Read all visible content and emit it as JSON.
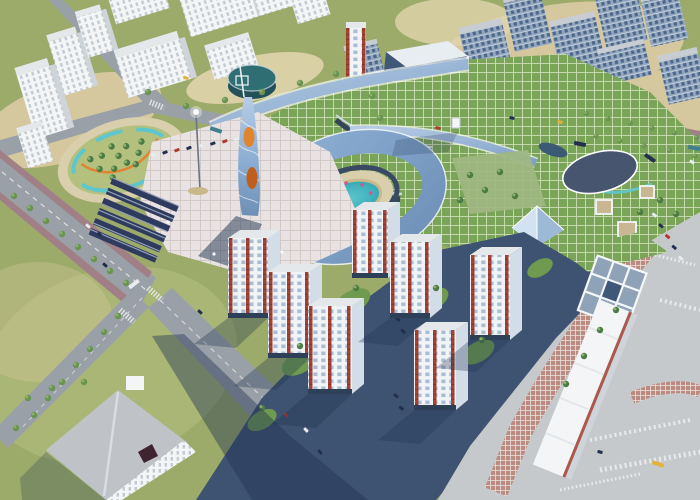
{
  "scene": {
    "type": "3d-aerial-architectural-render",
    "subject": "mixed-use development masterplan with shopping mall, ring courtyard, spiral tower, park and residential towers",
    "residential_tower_count": 9,
    "landmarks": [
      {
        "id": "spiral-tower",
        "label": "twisted glass tower with orange glowing bands"
      },
      {
        "id": "ring-building",
        "label": "C-shaped blue glass roof building around circular pool courtyard"
      },
      {
        "id": "courtyard-pool",
        "label": "teal pool with sandy rim and pink umbrellas"
      },
      {
        "id": "mall-green-roof",
        "label": "shopping mall with gridded green roofs"
      },
      {
        "id": "oval-pavilion",
        "label": "oval dark-roof pavilion on mall roof"
      },
      {
        "id": "glass-pyramid",
        "label": "glass pyramid skylight"
      },
      {
        "id": "drum-building",
        "label": "teal cylindrical drum building"
      },
      {
        "id": "office-tower",
        "label": "dark blue glass office slab"
      },
      {
        "id": "park-oval",
        "label": "oval park with tree cluster, teal pond ring and orange path"
      },
      {
        "id": "solar-carports",
        "label": "rows of dark solar carport canopies"
      },
      {
        "id": "residential-towers",
        "label": "white towers with red brick stripes"
      },
      {
        "id": "skybridge",
        "label": "blue glass skybridge tube"
      },
      {
        "id": "plaza-southeast",
        "label": "paved plaza with red paver bands and crosswalks"
      }
    ]
  },
  "colors": {
    "grass_base": "#9cab6a",
    "grass_light": "#b4c07e",
    "grass_dark": "#6f9a50",
    "sand": "#d6c89e",
    "sand_light": "#e0d4ac",
    "road": "#9aa0a7",
    "road_light": "#b3b7bc",
    "road_shadow": "#3e5271",
    "sidewalk_mauve": "#a08086",
    "paver_red": "#bb8b82",
    "paver_line": "#e9e0da",
    "white_bldg": "#f3f5f6",
    "white_bldg_window": "#c3cad1",
    "white_roof": "#e4e8eb",
    "white_side": "#ced4da",
    "blue_bldg": "#93a8bf",
    "blue_bldg_window": "#4e688b",
    "blue_roof": "#c8cdd3",
    "office_glass": "#3f5878",
    "office_line": "#8298b2",
    "office_trim": "#e8edf2",
    "mall_green_roof": "#7aa458",
    "mall_roof_grid": "#cddcb4",
    "mall_dark_wall": "#2f3f58",
    "mall_slat": "#cdd6df",
    "canopy_light": "#b6cce6",
    "canopy_dark": "#7e9fc6",
    "ring_glass": "#8fb0d4",
    "ring_glass_dark": "#6e90b8",
    "courtyard_deck": "#d9cfad",
    "pool_teal": "#5ec6cd",
    "pool_deep": "#35a8b4",
    "sand_rim": "#c8b88b",
    "umbrella_pink": "#d9538f",
    "wall_dark": "#3a4a64",
    "drum_top": "#2f6f74",
    "drum_side": "#235159",
    "pavilion_roof": "#47556e",
    "pyramid_light": "#d3e2f0",
    "pyramid_dark": "#9db9d6",
    "tower_white": "#f1f4f6",
    "tower_window": "#a9bed4",
    "tower_side": "#d3dde8",
    "tower_side_window": "#8ba4bf",
    "red_brick": "#a64234",
    "red_brick_dark": "#8c3526",
    "storefront": "#2e3f58",
    "tree_dark": "#4c7a44",
    "tree_mid": "#689450",
    "tree_light": "#8cb06a",
    "carport": "#2e3b5e",
    "carport_line": "#9aa7c0",
    "plaza": "#e9e2e2",
    "plaza_line": "#d2c9c9",
    "plaza_gray": "#c6c9cc",
    "spiral_orange": "#e08430",
    "spiral_orange_deep": "#c05f1d",
    "shadow": "#1e3350",
    "pond_navy": "#3c5a74",
    "garden_green": "#9fb782",
    "car_white": "#e8ecef",
    "car_dark": "#23304d",
    "car_red": "#b03a30",
    "car_yellow": "#e3b23a",
    "car_teal": "#3f7f8e",
    "banner_yellow": "#e4c23c",
    "banner_red": "#cc4f35",
    "mast_gray": "#6a7482",
    "glow_white": "#ffffff",
    "frame_white": "#f4f7f9",
    "glass_cell": "#8fa3b8",
    "roof_gray": "#bfc3c8",
    "roof_hole": "#3f2430",
    "tan_cell": "#c9b794"
  }
}
